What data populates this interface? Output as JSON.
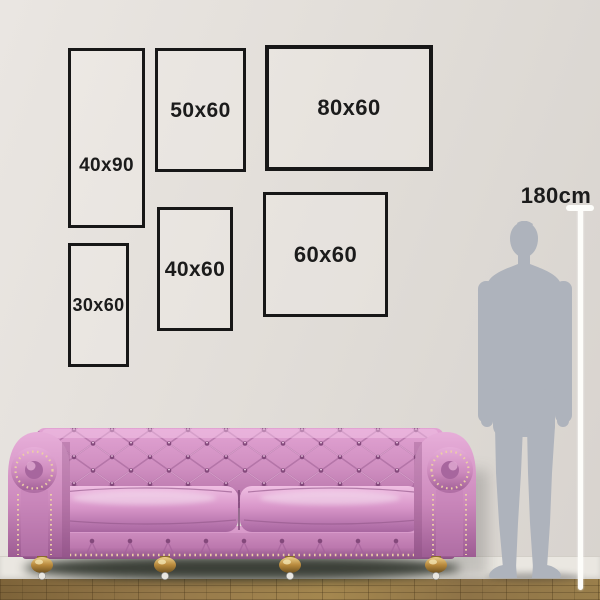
{
  "meta": {
    "type": "wall-art-size-guide"
  },
  "frames": [
    {
      "id": "40x90",
      "label": "40x90"
    },
    {
      "id": "50x60",
      "label": "50x60"
    },
    {
      "id": "80x60",
      "label": "80x60"
    },
    {
      "id": "30x60",
      "label": "30x60"
    },
    {
      "id": "40x60",
      "label": "40x60"
    },
    {
      "id": "60x60",
      "label": "60x60"
    }
  ],
  "height_reference": {
    "label": "180cm"
  },
  "colors": {
    "wall": "#e3dfda",
    "frame_border": "#171717",
    "label_text": "#1b1b1b",
    "ruler_white": "#fdfdfa",
    "silhouette_gray": "#aeb3bc",
    "sofa_pink": "#cf8ec0",
    "sofa_highlight": "#eebbdf",
    "sofa_dark": "#9c5f94",
    "feet_gold": "#b8893c",
    "floor_wood": "#8f7549",
    "baseboard": "#eae7e1"
  }
}
